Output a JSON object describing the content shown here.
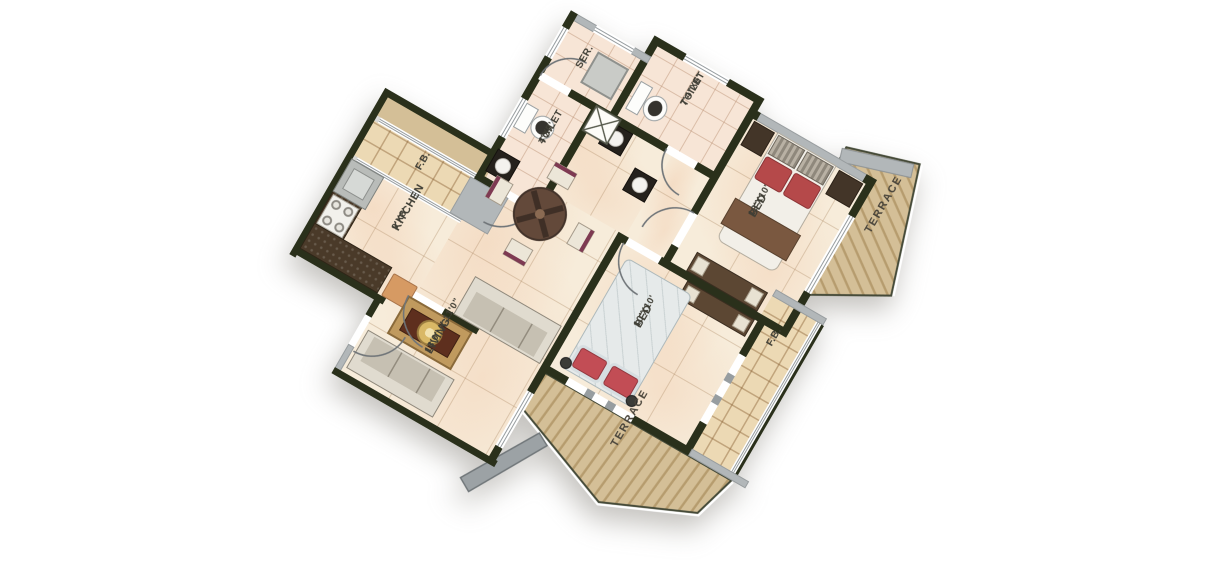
{
  "plan": {
    "type": "residential floor plan",
    "rotation_deg": 30,
    "rooms": {
      "kitchen": {
        "label": "KITCHEN",
        "dims": "9'X8'"
      },
      "living": {
        "label": "LIVING",
        "dims": "18'0\" X 11'0\""
      },
      "bed_master": {
        "label": "BED",
        "dims": "12'X10'"
      },
      "bed_second": {
        "label": "BED",
        "dims": "10'X10'"
      },
      "toilet_common": {
        "label": "TOILET",
        "dims": "4'X7'"
      },
      "toilet_master": {
        "label": "TOILET",
        "dims": "7'4\"X5'"
      },
      "servant": {
        "label": "SER."
      },
      "flower_bed_kitchen": {
        "label": "F.B."
      },
      "flower_bed_bed": {
        "label": "F.B."
      },
      "terrace_side": {
        "label": "TERRACE"
      },
      "terrace_front": {
        "label": "TERRACE"
      }
    },
    "colors": {
      "wall": "#2a301b",
      "concrete_wall": "#b2b7b9",
      "floor": "#f7ecda",
      "toilet_floor": "#f7e5d6",
      "terrace": "#d4bf97",
      "flower_bed_tile": "#ecd9b4",
      "bed_pillow_red": "#b5494a",
      "bed2_duvet": "#e6eaea",
      "sofa": "#c6c0b2",
      "coffee_table": "#5e2f1e",
      "dining_table": "#63493a",
      "kitchen_counter": "#4a3a29"
    }
  }
}
